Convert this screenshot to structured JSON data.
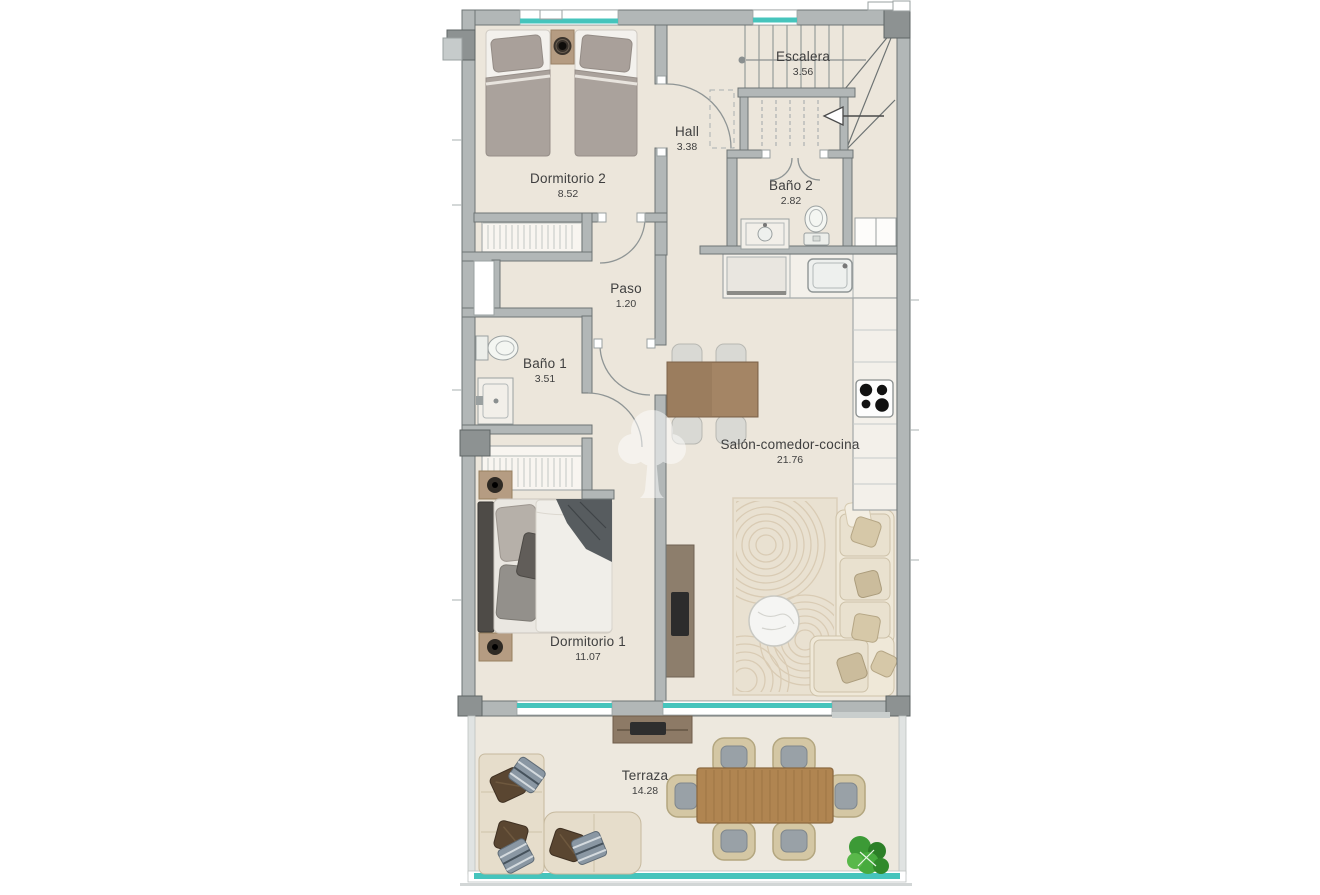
{
  "plan": {
    "title": "Apartment floor plan",
    "rooms": [
      {
        "key": "dormitorio-2",
        "name": "Dormitorio 2",
        "area": "8.52"
      },
      {
        "key": "escalera",
        "name": "Escalera",
        "area": "3.56"
      },
      {
        "key": "hall",
        "name": "Hall",
        "area": "3.38"
      },
      {
        "key": "bano-2",
        "name": "Baño 2",
        "area": "2.82"
      },
      {
        "key": "paso",
        "name": "Paso",
        "area": "1.20"
      },
      {
        "key": "bano-1",
        "name": "Baño 1",
        "area": "3.51"
      },
      {
        "key": "salon-comedor-cocina",
        "name": "Salón-comedor-cocina",
        "area": "21.76"
      },
      {
        "key": "dormitorio-1",
        "name": "Dormitorio 1",
        "area": "11.07"
      },
      {
        "key": "terraza",
        "name": "Terraza",
        "area": "14.28"
      }
    ],
    "colors": {
      "window_glass": "#46c4bc",
      "wall": "#b2b7b7",
      "wall_outline": "#6e7474",
      "floor": "#ece6db",
      "label_text": "#3f3f3f",
      "dining_wood": "#9b7d5e",
      "terrace_wood": "#b08551"
    },
    "watermark": "tree-logo"
  }
}
